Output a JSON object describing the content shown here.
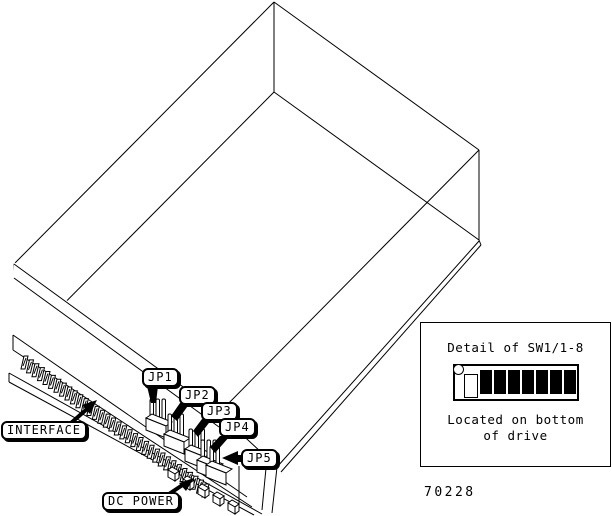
{
  "figure": {
    "drawing": {
      "type": "isometric line art",
      "subject": "disk drive showing connector and jumper locations"
    },
    "callouts": {
      "jp1": "JP1",
      "jp2": "JP2",
      "jp3": "JP3",
      "jp4": "JP4",
      "jp5": "JP5",
      "interface": "INTERFACE",
      "dc_power": "DC POWER"
    },
    "inset": {
      "title": "Detail of SW1/1-8",
      "caption": [
        "Located on bottom",
        "of drive"
      ],
      "dip_switch": {
        "positions": 8,
        "states": [
          "off",
          "on",
          "on",
          "on",
          "on",
          "on",
          "on",
          "on"
        ],
        "on_color": "#000000",
        "off_color": "#ffffff"
      }
    },
    "figure_number": "70228",
    "colors": {
      "line": "#000000",
      "background": "#ffffff"
    }
  }
}
